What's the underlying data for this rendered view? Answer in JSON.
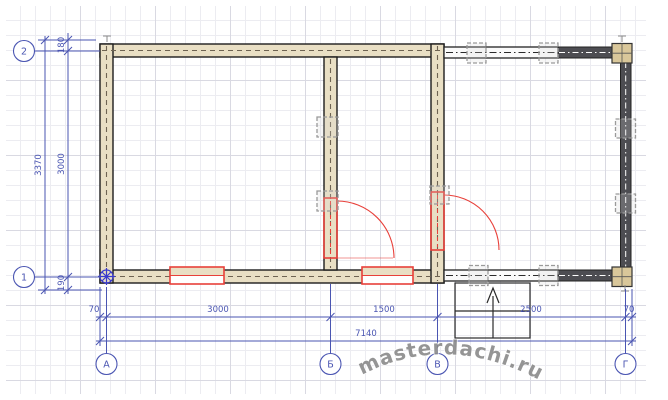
{
  "drawing": {
    "kind": "floor-plan",
    "watermark": "masterdachi.ru"
  },
  "axis_bubbles": {
    "left": [
      {
        "label": "2"
      },
      {
        "label": "1"
      }
    ],
    "bottom": [
      {
        "label": "А"
      },
      {
        "label": "Б"
      },
      {
        "label": "В"
      },
      {
        "label": "Г"
      }
    ]
  },
  "dims": {
    "v_overall": "3370",
    "v_axis": "3000",
    "v_top_offset": "180",
    "v_bottom_offset": "190",
    "h_row1": [
      "70",
      "3000",
      "1500",
      "2500",
      "70"
    ],
    "h_total": "7140"
  },
  "colors": {
    "dimension_blue": "#4a55b2",
    "survey_blue": "#3a3ace",
    "wall_fill": "#e9dfc4",
    "wall_edge": "#1c1c1c",
    "opening_red": "#e8403a",
    "corner_post_fill": "#d9c79a",
    "dark_beam": "#4d4d52",
    "marker_gray": "#9a9a9a",
    "watermark_gray": "#8a8a8a",
    "grid_minor": "#ececf1",
    "grid_major": "#d9d9e2"
  }
}
